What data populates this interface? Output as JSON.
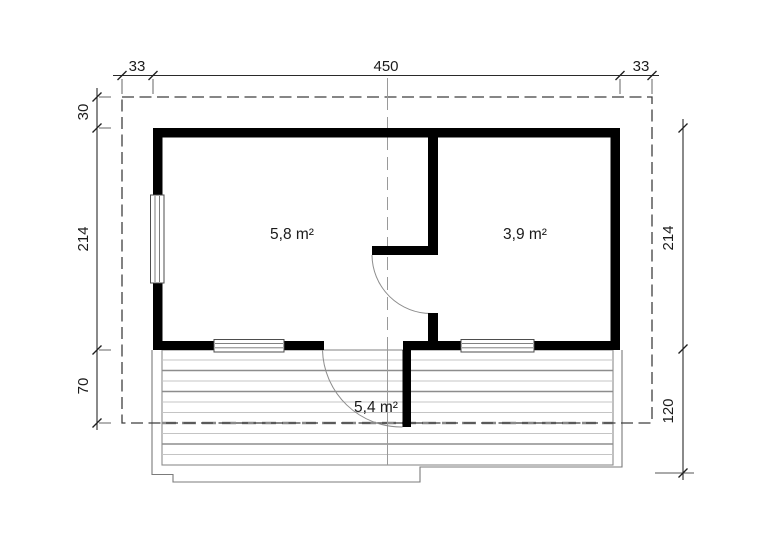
{
  "plan": {
    "areas": {
      "room_left": "5,8 m²",
      "room_right": "3,9 m²",
      "terrace": "5,4 m²"
    },
    "dimensions": {
      "top_left_overhang": "33",
      "top_width": "450",
      "top_right_overhang": "33",
      "left_roof_offset": "30",
      "left_depth": "214",
      "left_terrace_offset": "70",
      "right_depth": "214",
      "right_terrace_depth": "120"
    },
    "colors": {
      "wall": "#000000",
      "dimension_line": "#2a2a2a",
      "roof_dash": "#3f3f3f",
      "center_line": "#9a9a9a",
      "deck_plank_light": "#c4c4c4",
      "deck_plank_dark": "#8d8d8d",
      "terrace_outline": "#7b7b7b"
    }
  }
}
